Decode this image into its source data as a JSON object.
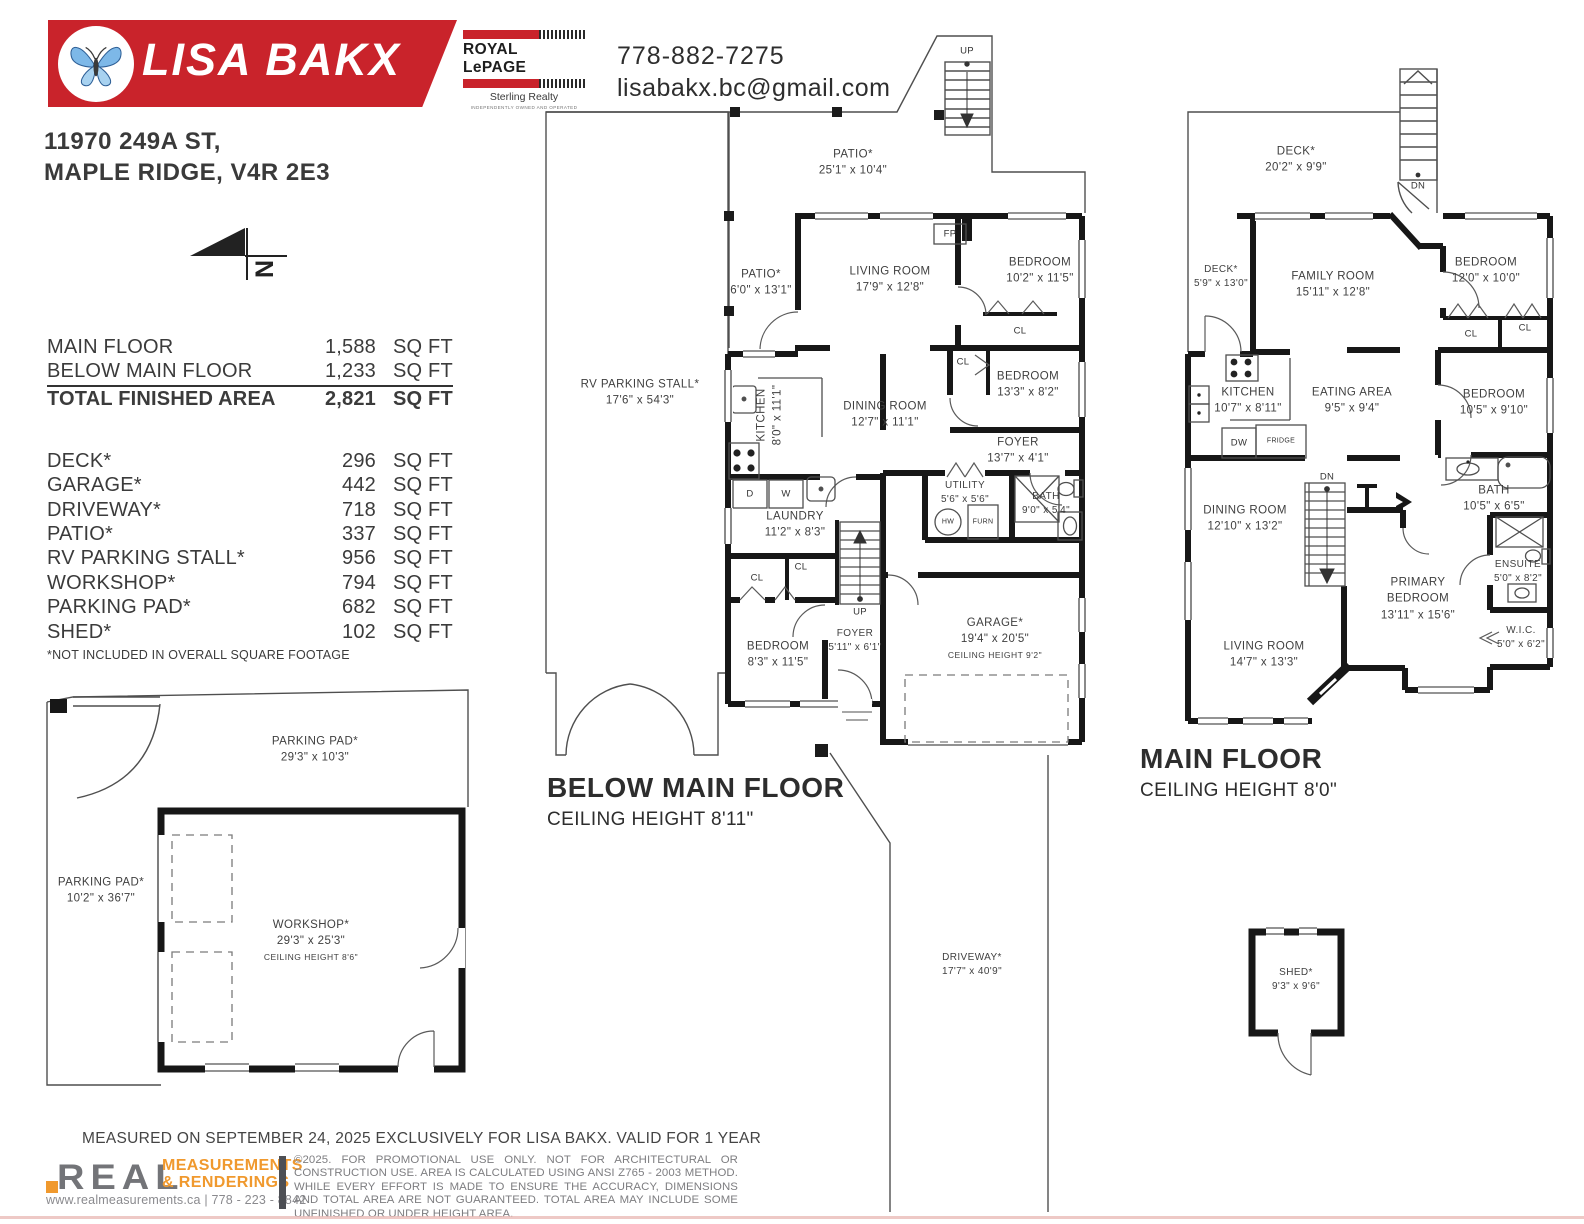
{
  "header": {
    "agent_name": "LISA BAKX",
    "brokerage": {
      "name": "ROYAL LePAGE",
      "division": "Sterling Realty",
      "tagline": "INDEPENDENTLY OWNED AND OPERATED"
    },
    "phone": "778-882-7275",
    "email": "lisabakx.bc@gmail.com"
  },
  "address": {
    "line1": "11970 249A ST,",
    "line2": "MAPLE RIDGE, V4R 2E3"
  },
  "compass": {
    "north": "N"
  },
  "area_table": {
    "finished": [
      {
        "label": "MAIN FLOOR",
        "value": "1,588",
        "unit": "SQ FT"
      },
      {
        "label": "BELOW MAIN FLOOR",
        "value": "1,233",
        "unit": "SQ FT"
      }
    ],
    "total": {
      "label": "TOTAL FINISHED AREA",
      "value": "2,821",
      "unit": "SQ FT"
    },
    "excluded": [
      {
        "label": "DECK*",
        "value": "296",
        "unit": "SQ FT"
      },
      {
        "label": "GARAGE*",
        "value": "442",
        "unit": "SQ FT"
      },
      {
        "label": "DRIVEWAY*",
        "value": "718",
        "unit": "SQ FT"
      },
      {
        "label": "PATIO*",
        "value": "337",
        "unit": "SQ FT"
      },
      {
        "label": "RV PARKING STALL*",
        "value": "956",
        "unit": "SQ FT"
      },
      {
        "label": "WORKSHOP*",
        "value": "794",
        "unit": "SQ FT"
      },
      {
        "label": "PARKING PAD*",
        "value": "682",
        "unit": "SQ FT"
      },
      {
        "label": "SHED*",
        "value": "102",
        "unit": "SQ FT"
      }
    ],
    "footnote": "*NOT INCLUDED IN OVERALL SQUARE FOOTAGE"
  },
  "plans": {
    "below_main": {
      "title": "BELOW MAIN FLOOR",
      "ceiling": "CEILING HEIGHT 8'11\"",
      "rooms": {
        "patio_top": {
          "name": "PATIO*",
          "dims": "25'1\" x 10'4\""
        },
        "patio_left": {
          "name": "PATIO*",
          "dims": "6'0\" x 13'1\""
        },
        "living": {
          "name": "LIVING ROOM",
          "dims": "17'9\" x 12'8\""
        },
        "bedroom1": {
          "name": "BEDROOM",
          "dims": "10'2\" x 11'5\""
        },
        "kitchen": {
          "name": "KITCHEN",
          "dims": "8'0\" x 11'1\""
        },
        "dining": {
          "name": "DINING ROOM",
          "dims": "12'7\" x 11'1\""
        },
        "bedroom2": {
          "name": "BEDROOM",
          "dims": "13'3\" x 8'2\""
        },
        "foyer_upper": {
          "name": "FOYER",
          "dims": "13'7\" x 4'1\""
        },
        "utility": {
          "name": "UTILITY",
          "dims": "5'6\" x 5'6\""
        },
        "bath": {
          "name": "BATH",
          "dims": "9'0\" x 5'4\""
        },
        "laundry": {
          "name": "LAUNDRY",
          "dims": "11'2\" x 8'3\""
        },
        "bedroom3": {
          "name": "BEDROOM",
          "dims": "8'3\" x 11'5\""
        },
        "foyer_lower": {
          "name": "FOYER",
          "dims": "5'11\" x 6'1\""
        },
        "garage": {
          "name": "GARAGE*",
          "dims": "19'4\" x 20'5\"",
          "note": "CEILING HEIGHT 9'2\""
        },
        "rv_stall": {
          "name": "RV PARKING STALL*",
          "dims": "17'6\" x 54'3\""
        }
      }
    },
    "main": {
      "title": "MAIN FLOOR",
      "ceiling": "CEILING HEIGHT 8'0\"",
      "rooms": {
        "deck_top": {
          "name": "DECK*",
          "dims": "20'2\" x 9'9\""
        },
        "deck_left": {
          "name": "DECK*",
          "dims": "5'9\" x 13'0\""
        },
        "family": {
          "name": "FAMILY ROOM",
          "dims": "15'11\" x 12'8\""
        },
        "bedroom_r": {
          "name": "BEDROOM",
          "dims": "12'0\" x 10'0\""
        },
        "kitchen": {
          "name": "KITCHEN",
          "dims": "10'7\" x 8'11\""
        },
        "eating": {
          "name": "EATING AREA",
          "dims": "9'5\" x 9'4\""
        },
        "bedroom_m": {
          "name": "BEDROOM",
          "dims": "10'5\" x 9'10\""
        },
        "dining": {
          "name": "DINING ROOM",
          "dims": "12'10\" x 13'2\""
        },
        "bath": {
          "name": "BATH",
          "dims": "10'5\" x 6'5\""
        },
        "primary": {
          "name": "PRIMARY BEDROOM",
          "dims": "13'11\" x 15'6\""
        },
        "ensuite": {
          "name": "ENSUITE",
          "dims": "5'0\" x 8'2\""
        },
        "wic": {
          "name": "W.I.C.",
          "dims": "5'0\" x 6'2\""
        },
        "living": {
          "name": "LIVING ROOM",
          "dims": "14'7\" x 13'3\""
        }
      }
    },
    "site": {
      "parking_pad_top": {
        "name": "PARKING PAD*",
        "dims": "29'3\" x 10'3\""
      },
      "parking_pad_left": {
        "name": "PARKING PAD*",
        "dims": "10'2\" x 36'7\""
      },
      "workshop": {
        "name": "WORKSHOP*",
        "dims": "29'3\" x 25'3\"",
        "note": "CEILING HEIGHT 8'6\""
      },
      "shed": {
        "name": "SHED*",
        "dims": "9'3\" x 9'6\""
      },
      "driveway": {
        "name": "DRIVEWAY*",
        "dims": "17'7\" x 40'9\""
      }
    },
    "small_labels": {
      "fp": "FP",
      "cl": "CL",
      "d": "D",
      "w": "W",
      "hw": "HW",
      "furn": "FURN",
      "up": "UP",
      "dn": "DN",
      "dw": "DW",
      "fridge": "FRIDGE"
    }
  },
  "footer": {
    "measured": "MEASURED ON SEPTEMBER 24, 2025 EXCLUSIVELY FOR LISA BAKX. VALID FOR 1 YEAR",
    "logo_word": "REAL",
    "logo_line1": "MEASUREMENTS",
    "logo_line2": "& RENDERINGS",
    "contact_line": "www.realmeasurements.ca | 778 - 223 - 8842",
    "disclaimer": "©2025. FOR PROMOTIONAL USE ONLY. NOT FOR ARCHITECTURAL OR CONSTRUCTION USE. AREA IS CALCULATED USING ANSI Z765 - 2003 METHOD. WHILE EVERY EFFORT IS MADE TO ENSURE THE ACCURACY, DIMENSIONS AND TOTAL AREA ARE NOT GUARANTEED. TOTAL AREA MAY INCLUDE SOME UNFINISHED OR UNDER HEIGHT AREA."
  }
}
